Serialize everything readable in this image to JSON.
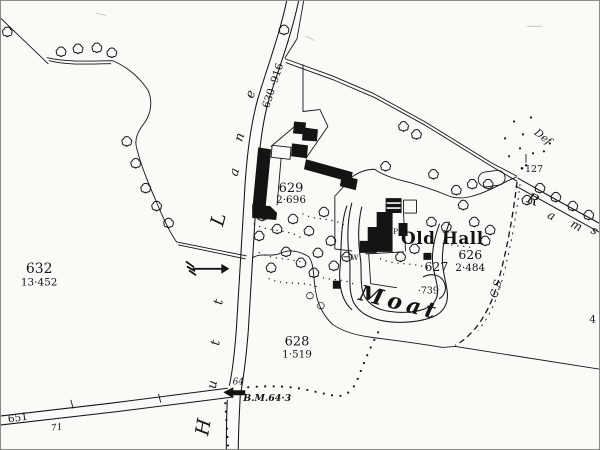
{
  "colors": {
    "paper": "#fbfaf6",
    "ink": "#141414",
    "border": "#8a8a86"
  },
  "names": {
    "old_hall": "Old Hall",
    "moat": "Moat"
  },
  "letters": {
    "hutt": [
      "H",
      "u",
      "t",
      "t"
    ],
    "lane": [
      "L",
      "a",
      "n",
      "e"
    ],
    "rams": [
      "R",
      "a",
      "m",
      "s"
    ]
  },
  "parcels": {
    "p632": {
      "number": "632",
      "area": "13·452"
    },
    "p629": {
      "number": "629",
      "area": "2·696"
    },
    "p628": {
      "number": "628",
      "area": "1·519"
    },
    "p626": {
      "number": "626",
      "area": "2·484"
    },
    "p627": {
      "number": "627"
    },
    "p630": {
      "number": "630",
      "area": "·916",
      "combined": "630  ·916"
    },
    "p651": {
      "number": "651"
    },
    "p739": {
      "number": "·739"
    }
  },
  "annotations": {
    "benchmark": "B.M.64·3",
    "spot_64": "64",
    "spot_71": "71",
    "post_127": "127",
    "boundary_def": "Def",
    "boundary_cs": "C.S",
    "edge_number": "4",
    "pump": "P",
    "well": "W"
  }
}
